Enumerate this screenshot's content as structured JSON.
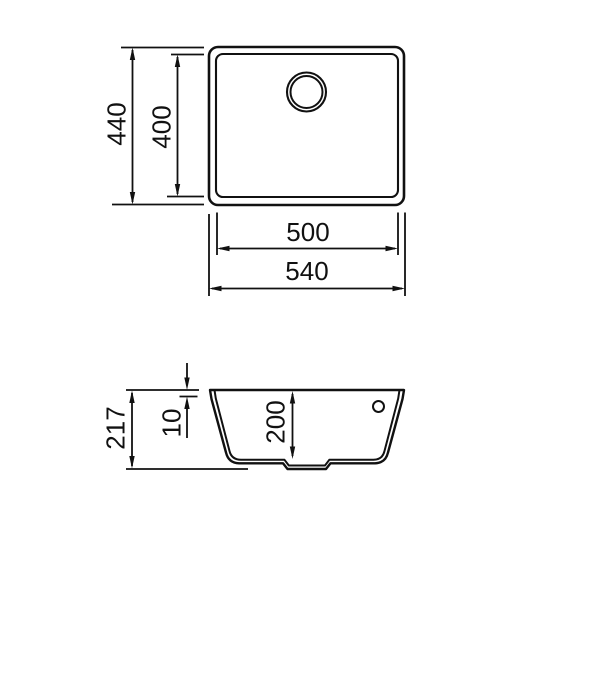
{
  "drawing": {
    "kind": "sink-technical-dimension-drawing",
    "line_color": "#111111",
    "background_color": "#ffffff",
    "top_view": {
      "outer_height": "440",
      "inner_height": "400",
      "inner_width": "500",
      "outer_width": "540"
    },
    "section_view": {
      "total_depth": "217",
      "rim_inset": "10",
      "bowl_depth": "200"
    }
  }
}
